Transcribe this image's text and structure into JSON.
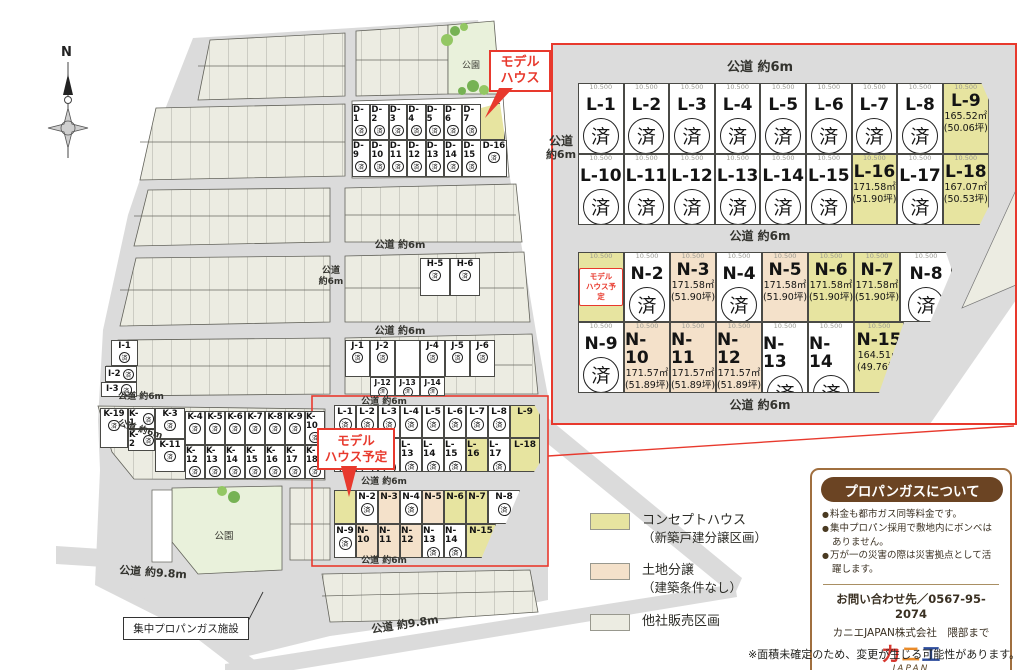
{
  "disclaimer": "※面積未確定のため、変更が生じる可能性があります。",
  "compass_n": "N",
  "roads": {
    "r6": "公道 約6m",
    "r6a": "公道",
    "r6b": "約6m",
    "r98": "公道 約9.8m"
  },
  "park": "公園",
  "sold_mark": "済",
  "callouts": {
    "model_house": [
      "モデル",
      "ハウス"
    ],
    "model_house_plan": [
      "モデル",
      "ハウス予定"
    ],
    "propane_facility": "集中プロパンガス施設"
  },
  "legend": [
    {
      "label": "コンセプトハウス",
      "sub": "（新築戸建分譲区画）",
      "type": "concept"
    },
    {
      "label": "土地分譲",
      "sub": "（建築条件なし）",
      "type": "land"
    },
    {
      "label": "他社販売区画",
      "sub": "",
      "type": "other"
    }
  ],
  "propane": {
    "title": "プロパンガスについて",
    "bullets": [
      "料金も都市ガス同等料金です。",
      "集中プロパン採用で敷地内にボンベはありません。",
      "万が一の災害の際は災害拠点として活躍します。"
    ],
    "contact": "お問い合わせ先／0567-95-2074",
    "company": "カニエJAPAN株式会社　隈部まで",
    "logo_chars": [
      "カ",
      "ニ",
      "エ"
    ],
    "logo_sub": "JAPAN"
  },
  "inset": {
    "dim": "10.500",
    "rows": {
      "l1": [
        {
          "id": "L-1",
          "sold": true
        },
        {
          "id": "L-2",
          "sold": true
        },
        {
          "id": "L-3",
          "sold": true
        },
        {
          "id": "L-4",
          "sold": true
        },
        {
          "id": "L-5",
          "sold": true
        },
        {
          "id": "L-6",
          "sold": true
        },
        {
          "id": "L-7",
          "sold": true
        },
        {
          "id": "L-8",
          "sold": true
        },
        {
          "id": "L-9",
          "type": "concept",
          "sq": "165.52㎡",
          "tb": "(50.06坪)"
        }
      ],
      "l2": [
        {
          "id": "L-10",
          "sold": true
        },
        {
          "id": "L-11",
          "sold": true
        },
        {
          "id": "L-12",
          "sold": true
        },
        {
          "id": "L-13",
          "sold": true
        },
        {
          "id": "L-14",
          "sold": true
        },
        {
          "id": "L-15",
          "sold": true
        },
        {
          "id": "L-16",
          "type": "concept",
          "sq": "171.58㎡",
          "tb": "(51.90坪)"
        },
        {
          "id": "L-17",
          "sold": true
        },
        {
          "id": "L-18",
          "type": "concept",
          "sq": "167.07㎡",
          "tb": "(50.53坪)"
        }
      ],
      "n1": [
        {
          "id": "",
          "type": "concept",
          "model": true
        },
        {
          "id": "N-2",
          "sold": true
        },
        {
          "id": "N-3",
          "type": "land",
          "sq": "171.58㎡",
          "tb": "(51.90坪)"
        },
        {
          "id": "N-4",
          "sold": true
        },
        {
          "id": "N-5",
          "type": "land",
          "sq": "171.58㎡",
          "tb": "(51.90坪)"
        },
        {
          "id": "N-6",
          "type": "concept",
          "sq": "171.58㎡",
          "tb": "(51.90坪)"
        },
        {
          "id": "N-7",
          "type": "concept",
          "sq": "171.58㎡",
          "tb": "(51.90坪)"
        },
        {
          "id": "N-8",
          "sold": true
        }
      ],
      "n2": [
        {
          "id": "N-9",
          "sold": true
        },
        {
          "id": "N-10",
          "type": "land",
          "sq": "171.57㎡",
          "tb": "(51.89坪)"
        },
        {
          "id": "N-11",
          "type": "land",
          "sq": "171.57㎡",
          "tb": "(51.89坪)"
        },
        {
          "id": "N-12",
          "type": "land",
          "sq": "171.57㎡",
          "tb": "(51.89坪)"
        },
        {
          "id": "N-13",
          "sold": true
        },
        {
          "id": "N-14",
          "sold": true
        },
        {
          "id": "N-15",
          "type": "concept",
          "sq": "164.51㎡",
          "tb": "(49.76坪)"
        }
      ]
    }
  },
  "map_lots": {
    "d1": [
      "D-1",
      "D-2",
      "D-3",
      "D-4",
      "D-5",
      "D-6",
      "D-7"
    ],
    "d2": [
      "D-9",
      "D-10",
      "D-11",
      "D-12",
      "D-13",
      "D-14",
      "D-15"
    ],
    "d16": "D-16",
    "h": [
      "H-5",
      "H-6"
    ],
    "i": [
      "I-1",
      "I-2",
      "I-3"
    ],
    "j1": [
      "J-1",
      "J-2",
      "",
      "J-4",
      "J-5",
      "J-6"
    ],
    "j2": [
      "J-12",
      "J-13",
      "J-14"
    ],
    "k_left": [
      "K-19",
      "K-1",
      "K-2",
      "K-3",
      "K-11"
    ],
    "k1": [
      "K-4",
      "K-5",
      "K-6",
      "K-7",
      "K-8",
      "K-9",
      "K-10"
    ],
    "k2": [
      "K-12",
      "K-13",
      "K-14",
      "K-15",
      "K-16",
      "K-17",
      "K-18"
    ],
    "sl1": [
      {
        "id": "L-1",
        "sold": true
      },
      {
        "id": "L-2",
        "sold": true
      },
      {
        "id": "L-3",
        "sold": true
      },
      {
        "id": "L-4",
        "sold": true
      },
      {
        "id": "L-5",
        "sold": true
      },
      {
        "id": "L-6",
        "sold": true
      },
      {
        "id": "L-7",
        "sold": true
      },
      {
        "id": "L-8",
        "sold": true
      },
      {
        "id": "L-9",
        "type": "concept"
      }
    ],
    "sl2": [
      {
        "id": "L-10",
        "sold": true
      },
      {
        "id": "L-11",
        "sold": true
      },
      {
        "id": "L-12",
        "sold": true
      },
      {
        "id": "L-13",
        "sold": true
      },
      {
        "id": "L-14",
        "sold": true
      },
      {
        "id": "L-15",
        "sold": true
      },
      {
        "id": "L-16",
        "type": "concept"
      },
      {
        "id": "L-17",
        "sold": true
      },
      {
        "id": "L-18",
        "type": "concept"
      }
    ],
    "sn1": [
      {
        "id": "",
        "type": "concept"
      },
      {
        "id": "N-2",
        "sold": true
      },
      {
        "id": "N-3",
        "type": "land"
      },
      {
        "id": "N-4",
        "sold": true
      },
      {
        "id": "N-5",
        "type": "land"
      },
      {
        "id": "N-6",
        "type": "concept"
      },
      {
        "id": "N-7",
        "type": "concept"
      },
      {
        "id": "N-8",
        "sold": true
      }
    ],
    "sn2": [
      {
        "id": "N-9",
        "sold": true
      },
      {
        "id": "N-10",
        "type": "land"
      },
      {
        "id": "N-11",
        "type": "land"
      },
      {
        "id": "N-12",
        "type": "land"
      },
      {
        "id": "N-13",
        "sold": true
      },
      {
        "id": "N-14",
        "sold": true
      },
      {
        "id": "N-15",
        "type": "concept"
      }
    ]
  },
  "colors": {
    "concept": "#E7E4A0",
    "land": "#F4E1CA",
    "other": "#ECECE2",
    "accent_red": "#E8392D",
    "brown": "#6B4423"
  }
}
